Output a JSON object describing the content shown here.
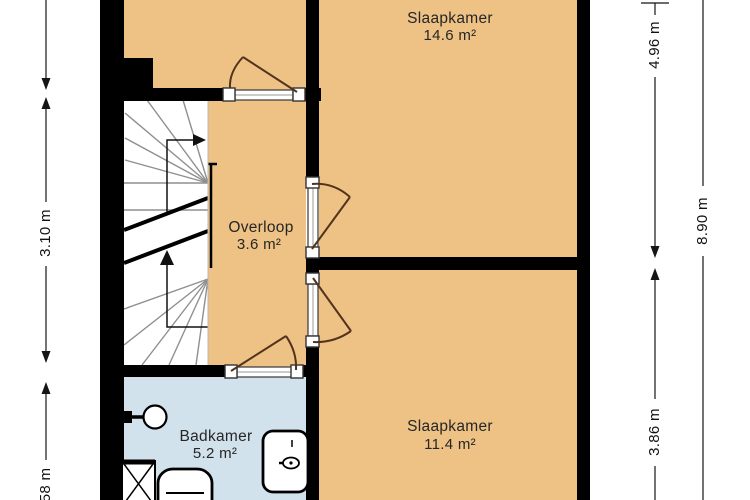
{
  "title": "Floor plan - verdieping (floorplan diagram)",
  "rooms": [
    {
      "id": "slaapkamer-1",
      "name": "Slaapkamer",
      "area": "14.6 m²"
    },
    {
      "id": "overloop",
      "name": "Overloop",
      "area": "3.6 m²"
    },
    {
      "id": "badkamer",
      "name": "Badkamer",
      "area": "5.2 m²"
    },
    {
      "id": "slaapkamer-2",
      "name": "Slaapkamer",
      "area": "11.4 m²"
    }
  ],
  "dimensions": {
    "left": [
      {
        "label": "3.10 m"
      },
      {
        "label": "58 m"
      }
    ],
    "right": [
      {
        "label": "4.96 m"
      },
      {
        "label": "8.90 m"
      },
      {
        "label": "3.86 m"
      }
    ]
  },
  "fixtures": [
    "sink",
    "shower",
    "toilet",
    "washer"
  ],
  "stairs": {
    "direction": "up",
    "arrows": 2
  },
  "colors": {
    "room_floor": "#EEC185",
    "bathroom_floor": "#D2E2ED",
    "stair_floor": "#FFFFFF",
    "wall": "#000000",
    "door": "#52341C",
    "stair_line": "#8F8F8F",
    "dimension": "#151515"
  }
}
